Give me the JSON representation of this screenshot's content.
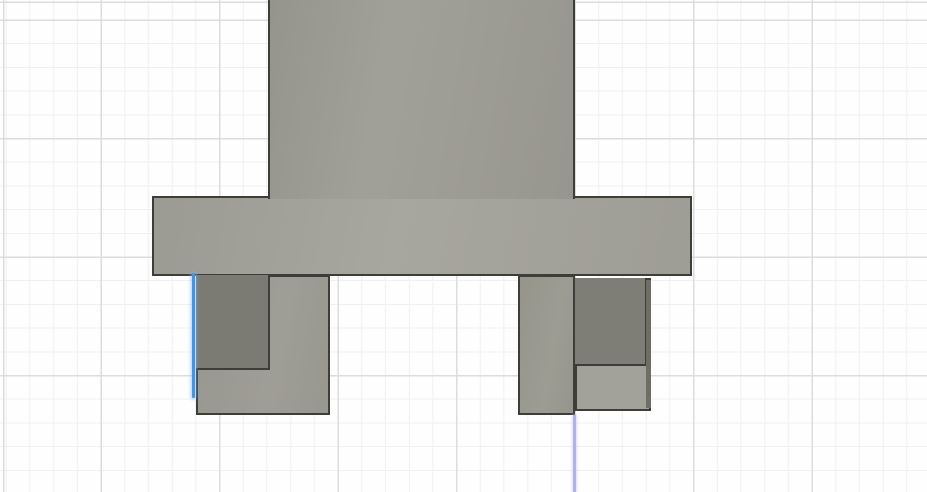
{
  "canvas": {
    "width": 927,
    "height": 492,
    "background": "#fefefe"
  },
  "grid": {
    "minor_spacing": 23.7,
    "major_spacing": 118.5,
    "minor_color": "#f0f0f0",
    "major_color": "#dcdcdc",
    "offset_x_minor": 5.8,
    "offset_y_minor": 19.5,
    "offset_x_major": 100.5,
    "offset_y_major": 19.5
  },
  "model": {
    "outline_color": "#3e3e38",
    "faces": [
      {
        "name": "flange-face",
        "x": 152,
        "y": 196,
        "w": 540,
        "h": 80,
        "fill": "#a2a199"
      },
      {
        "name": "body-face",
        "x": 268,
        "y": 0,
        "w": 307,
        "h": 199,
        "fill": "#9c9b93"
      },
      {
        "name": "left-leg-face",
        "x": 196,
        "y": 275,
        "w": 134,
        "h": 140,
        "fill": "#9b9a92"
      },
      {
        "name": "left-leg-recess-face",
        "x": 196,
        "y": 275,
        "w": 74,
        "h": 95,
        "fill": "#7c7b73"
      },
      {
        "name": "right-leg-column-face",
        "x": 518,
        "y": 275,
        "w": 57,
        "h": 140,
        "fill": "#99988f"
      },
      {
        "name": "right-leg-foot-face",
        "x": 575,
        "y": 278,
        "w": 76,
        "h": 133,
        "fill": "#a3a29a"
      },
      {
        "name": "right-leg-recess-face",
        "x": 575,
        "y": 278,
        "w": 72,
        "h": 88,
        "fill": "#7e7e76"
      },
      {
        "name": "right-leg-side-face",
        "x": 646,
        "y": 280,
        "w": 5,
        "h": 128,
        "fill": "#6f6e66"
      }
    ]
  },
  "overlays": {
    "selected_edge": {
      "name": "selected-edge-highlight",
      "x": 192,
      "y": 273,
      "w": 3,
      "h": 125,
      "color": "#3f96e6"
    },
    "sketch_line": {
      "name": "sketch-line",
      "x": 573,
      "y": 415,
      "w": 3,
      "h": 77,
      "color": "#b2b2e8"
    }
  }
}
